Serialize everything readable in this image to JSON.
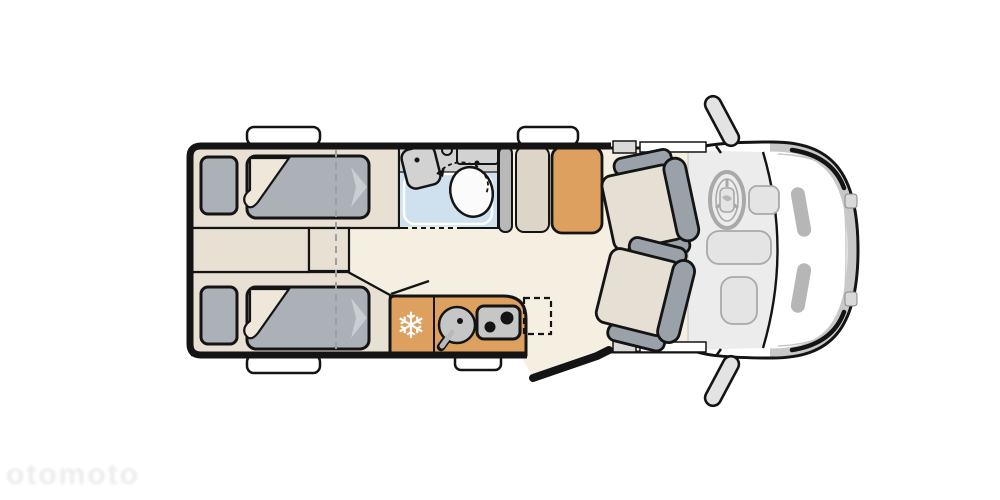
{
  "meta": {
    "title": "Motorhome floor plan – top view",
    "description": "Schematic camper layout: two single beds at rear with center aisle steps, bathroom with shower tray, washbasin and swivel toilet, wardrobe units, kitchen block with compressor fridge, round sink and two-burner hob, open entry door, two swivelled cab seats, dashboard with steering wheel, van front with side mirrors."
  },
  "watermark": {
    "text": "otomoto"
  },
  "icons": {
    "freezer_icon": "❄"
  },
  "colors": {
    "outline": "#141414",
    "white": "#ffffff",
    "floor": "#f5efe2",
    "platform": "#e8e0d2",
    "foldBeige": "#efe8da",
    "mattress": "#abb1b6",
    "chevron": "#c9ced3",
    "bathroomFloor": "#cfe0ef",
    "showerLine": "#ffffff",
    "fixtureGray": "#d2d2d2",
    "toiletWhite": "#fbfbfb",
    "wardrobeGray": "#b8b8b8",
    "wardrobeBeige": "#ddd5c7",
    "accentOrange": "#dda05e",
    "applianceGray": "#c6c6c6",
    "seatCushion": "#e6dfd3",
    "seatFrame": "#9aa1a8",
    "cabLight": "#ececec",
    "dashPanel": "#e4e4e4",
    "bodyTrim": "#c8c8c8",
    "hoodStrip": "#b6b6b6",
    "windowGray": "#d9d9d9",
    "mirrorGray": "#e3e3e3",
    "dashLine": "#a9a9a9",
    "softLine": "#c9c9c9",
    "watermark": "#ebebeb"
  }
}
